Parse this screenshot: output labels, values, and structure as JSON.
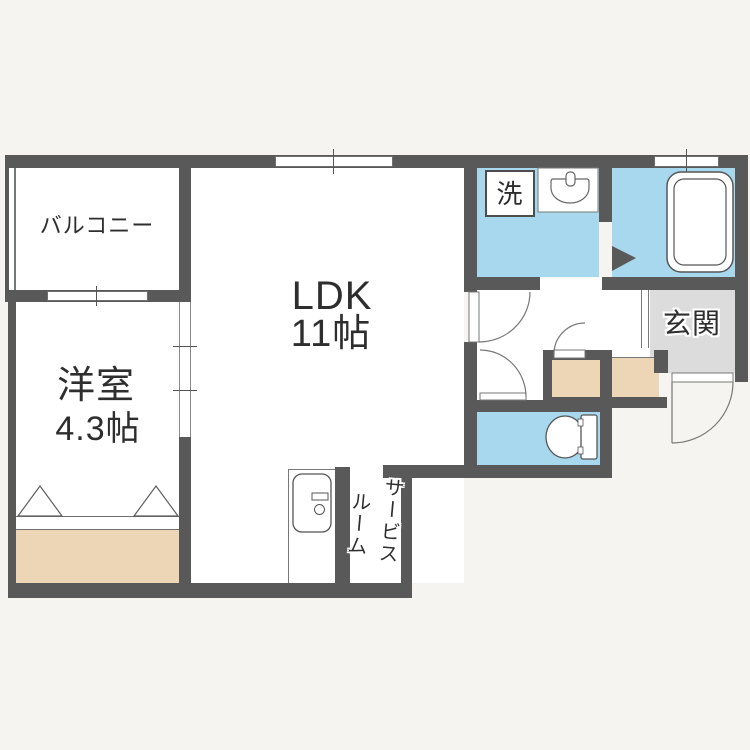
{
  "plan": {
    "rooms": {
      "balcony": {
        "label": "バルコニー"
      },
      "western_room": {
        "label": "洋室",
        "size": "4.3帖"
      },
      "ldk": {
        "label": "LDK",
        "size": "11帖"
      },
      "laundry": {
        "label": "洗"
      },
      "entrance": {
        "label": "玄関"
      },
      "service_room": {
        "label_line1": "サービス",
        "label_line2": "ルーム"
      }
    }
  },
  "colors": {
    "bg": "#f5f4f1",
    "room": "#ffffff",
    "wall": "#595959",
    "water": "#a8d8ee",
    "storage": "#ecd6b5",
    "entry": "#dcdcdc",
    "line": "#787878",
    "ink": "#2e2e2e"
  }
}
